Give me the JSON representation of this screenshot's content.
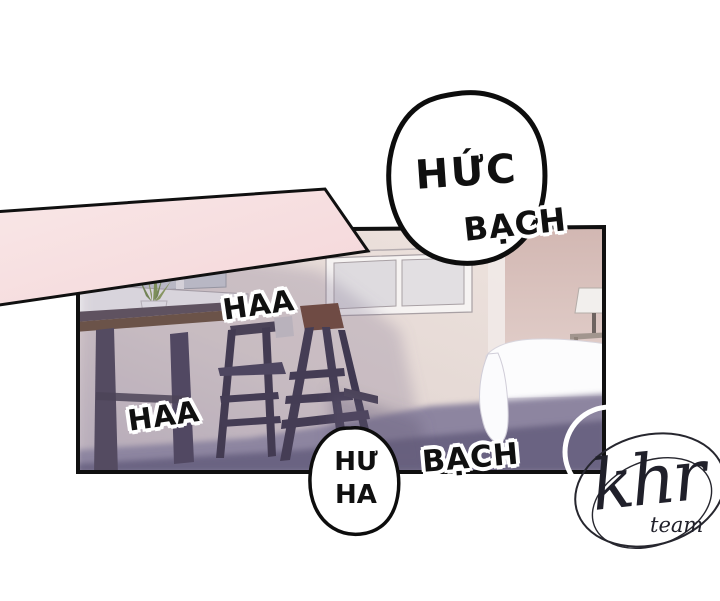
{
  "panel": {
    "sfx_huc": "HỨC",
    "sfx_bach_top": "BẠCH",
    "sfx_haa_top": "HAA",
    "sfx_haa_bottom": "HAA",
    "bubble_bottom_line1": "HƯ",
    "bubble_bottom_line2": "HA",
    "sfx_bach_bottom": "BẠCH"
  },
  "watermark": {
    "logo": "khr",
    "sub": "team"
  },
  "colors": {
    "background": "#ffffff",
    "band_pink": "#f7dedf",
    "outline_black": "#101010",
    "bubble_white": "#ffffff",
    "wall_light": "#ece1dc",
    "wall_right": "#d6bcb6",
    "floor_shadow_dark": "#6b6482",
    "floor_shadow_mid": "#8d85a0",
    "furniture_dark": "#473f55",
    "bed_white": "#fcfcfd",
    "plant_green": "#7d9a45",
    "watermark_ink": "#22222b"
  }
}
